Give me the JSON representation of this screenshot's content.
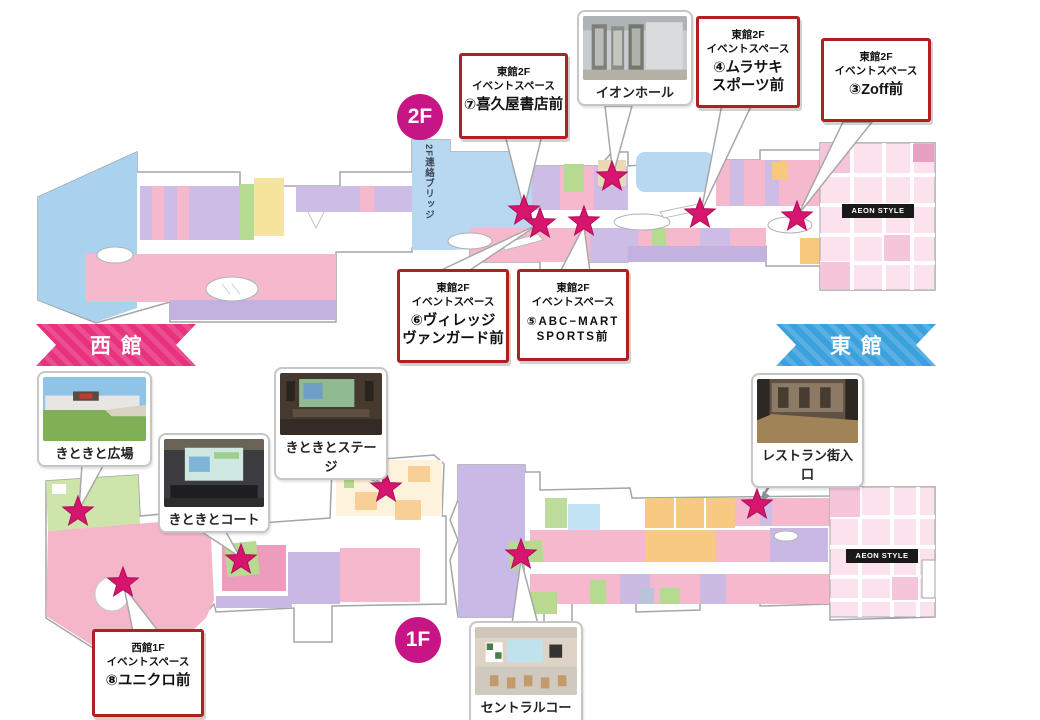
{
  "floor_badges": {
    "f2": "2F",
    "f1": "1F"
  },
  "bridge_label": "2F連絡ブリッジ",
  "banners": {
    "west": {
      "label": "西館",
      "color": "#e8327e"
    },
    "east": {
      "label": "東館",
      "color": "#3ba1dc"
    }
  },
  "store_labels": {
    "aeon_style_2f": "AEON STYLE",
    "aeon_style_1f": "AEON STYLE"
  },
  "callouts": [
    {
      "id": "kikuya",
      "building_floor": "東館2F",
      "space_label": "イベントスペース",
      "title_line1": "⑦喜久屋書店前",
      "title_line2": ""
    },
    {
      "id": "murasaki",
      "building_floor": "東館2F",
      "space_label": "イベントスペース",
      "title_line1": "④ムラサキ",
      "title_line2": "スポーツ前"
    },
    {
      "id": "zoff",
      "building_floor": "東館2F",
      "space_label": "イベントスペース",
      "title_line1": "③Zoff前",
      "title_line2": ""
    },
    {
      "id": "village",
      "building_floor": "東館2F",
      "space_label": "イベントスペース",
      "title_line1": "⑥ヴィレッジ",
      "title_line2": "ヴァンガード前"
    },
    {
      "id": "abcmart",
      "building_floor": "東館2F",
      "space_label": "イベントスペース",
      "title_line1": "⑤ABC−MART",
      "title_line2": "SPORTS前"
    },
    {
      "id": "uniqlo",
      "building_floor": "西館1F",
      "space_label": "イベントスペース",
      "title_line1": "⑧ユニクロ前",
      "title_line2": ""
    }
  ],
  "photo_callouts": [
    {
      "id": "aeon-hall",
      "label": "イオンホール"
    },
    {
      "id": "kitokito-hiroba",
      "label": "きときと広場"
    },
    {
      "id": "kitokito-court",
      "label": "きときとコート"
    },
    {
      "id": "kitokito-stage",
      "label": "きときとステージ"
    },
    {
      "id": "restaurant-entrance",
      "label": "レストラン街入口"
    },
    {
      "id": "central-court",
      "label": "セントラルコート"
    }
  ],
  "colors": {
    "star": "#d6156e",
    "callout_border": "#b02020",
    "floor_badge": "#c81586",
    "west_banner": "#e8327e",
    "east_banner": "#3ba1dc"
  }
}
